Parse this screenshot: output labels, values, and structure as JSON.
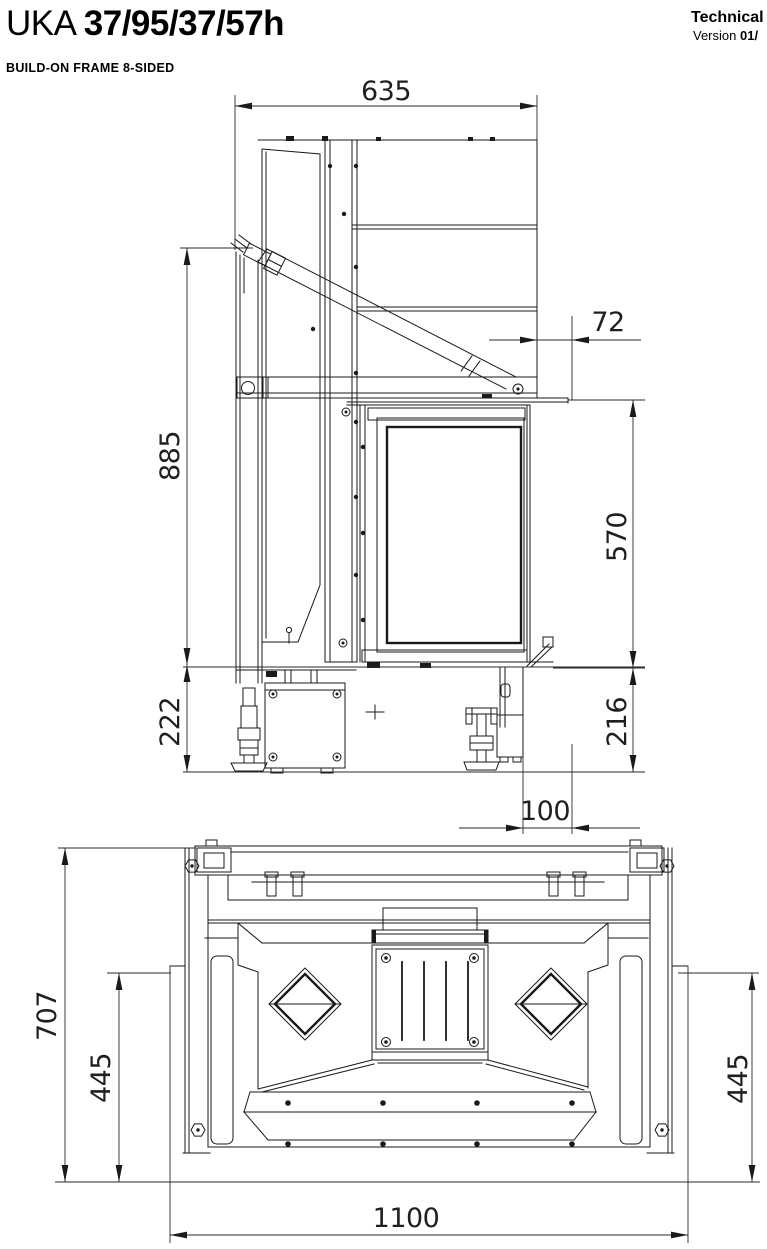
{
  "header": {
    "series": "UKA",
    "model": "37/95/37/57h",
    "subtitle": "BUILD-ON FRAME 8-SIDED",
    "doc_type": "Technical",
    "version_label": "Version",
    "version_number": "01/"
  },
  "side_view": {
    "dims": {
      "top_width": "635",
      "flue_offset": "72",
      "body_height": "885",
      "door_height": "570",
      "base_height_left": "222",
      "base_height_right": "216",
      "base_offset": "100"
    }
  },
  "top_view": {
    "dims": {
      "depth": "707",
      "inner_depth_left": "445",
      "inner_depth_right": "445",
      "overall_width": "1100"
    }
  },
  "colors": {
    "line": "#1a1a1a",
    "background": "#ffffff"
  }
}
